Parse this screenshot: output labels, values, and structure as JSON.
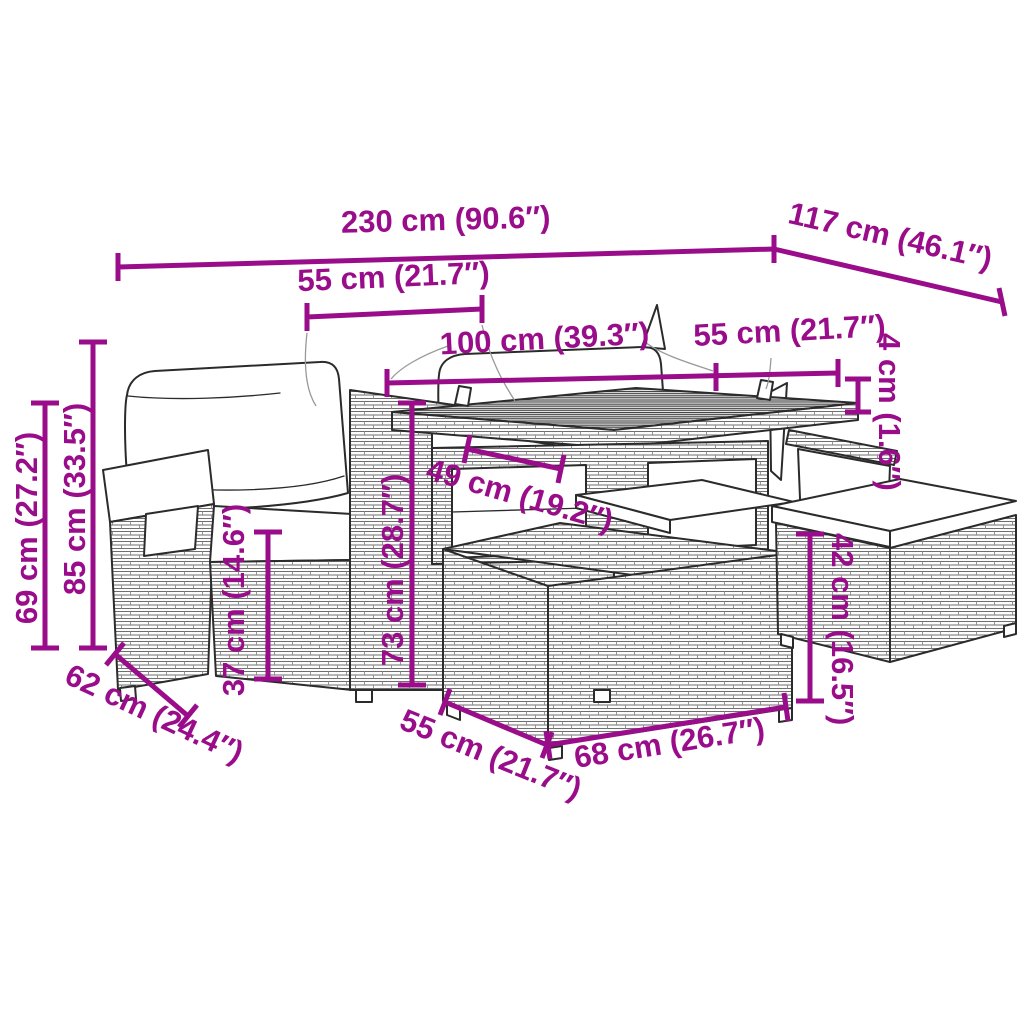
{
  "meta": {
    "accent_color": "#9A0D8A",
    "line_color": "#2b2b2b",
    "background_color": "#ffffff",
    "drawing": "outdoor-rattan-lounge-set-dimension-diagram"
  },
  "dimensions": {
    "total_width": {
      "cm": 230,
      "in": 90.6,
      "label": "230 cm (90.6″)"
    },
    "total_depth": {
      "cm": 117,
      "in": 46.1,
      "label": "117 cm (46.1″)"
    },
    "seat_width": {
      "cm": 55,
      "in": 21.7,
      "label": "55 cm (21.7″)"
    },
    "table_length": {
      "cm": 100,
      "in": 39.3,
      "label": "100 cm (39.3″)"
    },
    "table_width": {
      "cm": 55,
      "in": 21.7,
      "label": "55 cm (21.7″)"
    },
    "tabletop_thickness": {
      "cm": 4,
      "in": 1.6,
      "label": "4 cm (1.6″)"
    },
    "shelf_width": {
      "cm": 49,
      "in": 19.2,
      "label": "49 cm (19.2″)"
    },
    "table_height": {
      "cm": 73,
      "in": 28.7,
      "label": "73 cm (28.7″)"
    },
    "seat_height": {
      "cm": 37,
      "in": 14.6,
      "label": "37 cm (14.6″)"
    },
    "backrest_height": {
      "cm": 85,
      "in": 33.5,
      "label": "85 cm (33.5″)"
    },
    "armrest_height": {
      "cm": 69,
      "in": 27.2,
      "label": "69 cm (27.2″)"
    },
    "sofa_depth": {
      "cm": 62,
      "in": 24.4,
      "label": "62 cm (24.4″)"
    },
    "ottoman_width": {
      "cm": 55,
      "in": 21.7,
      "label": "55 cm (21.7″)"
    },
    "ottoman_length": {
      "cm": 68,
      "in": 26.7,
      "label": "68 cm (26.7″)"
    },
    "ottoman_height": {
      "cm": 42,
      "in": 16.5,
      "label": "42 cm (16.5″)"
    }
  }
}
